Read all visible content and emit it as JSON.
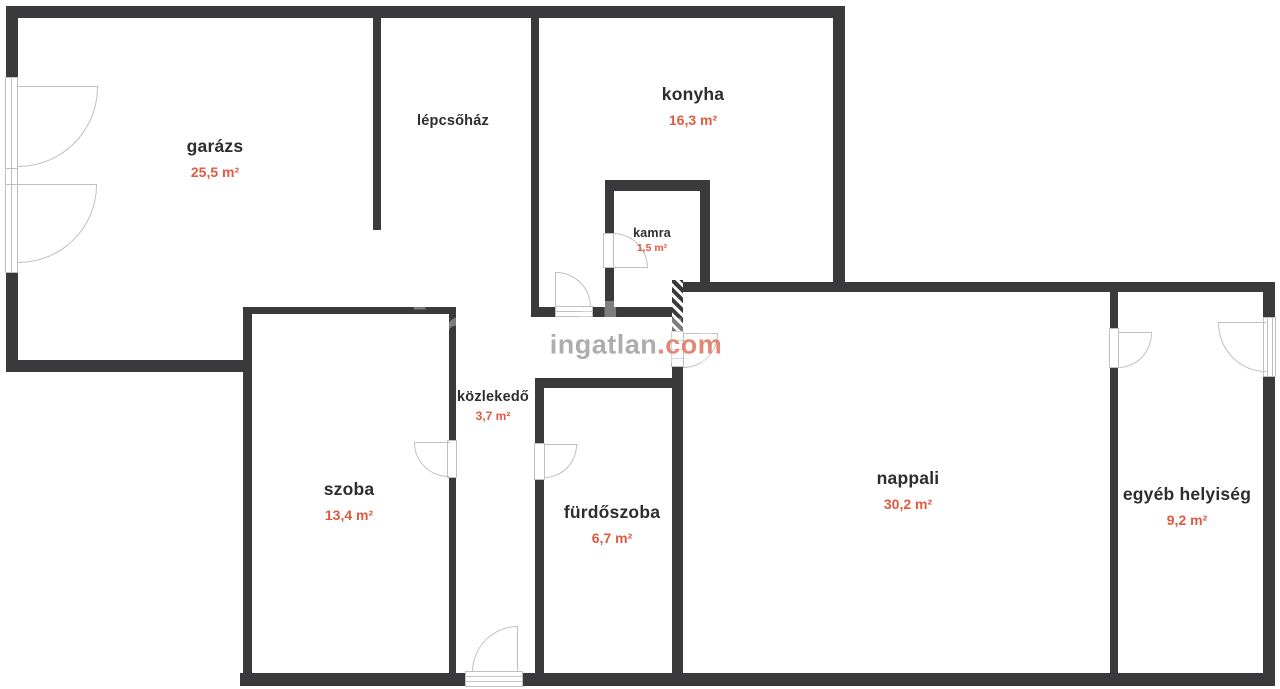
{
  "watermark": {
    "brand": "ingatlan",
    "tld": ".com"
  },
  "rooms": [
    {
      "id": "garazs",
      "name": "garázs",
      "area": "25,5 m²"
    },
    {
      "id": "lepcsohaz",
      "name": "lépcsőház",
      "area": ""
    },
    {
      "id": "konyha",
      "name": "konyha",
      "area": "16,3 m²"
    },
    {
      "id": "kamra",
      "name": "kamra",
      "area": "1,5 m²"
    },
    {
      "id": "kozlekedo",
      "name": "közlekedő",
      "area": "3,7 m²"
    },
    {
      "id": "szoba",
      "name": "szoba",
      "area": "13,4 m²"
    },
    {
      "id": "furdoszoba",
      "name": "fürdőszoba",
      "area": "6,7 m²"
    },
    {
      "id": "nappali",
      "name": "nappali",
      "area": "30,2 m²"
    },
    {
      "id": "egyeb",
      "name": "egyéb helyiség",
      "area": "9,2 m²"
    }
  ],
  "colors": {
    "wall": "#3a3a3c",
    "room_name": "#2d2d2f",
    "area_text": "#df5a41",
    "door_line": "#c0c0c3",
    "watermark_gray": "#a7a7ab",
    "watermark_accent": "#e0806a"
  }
}
